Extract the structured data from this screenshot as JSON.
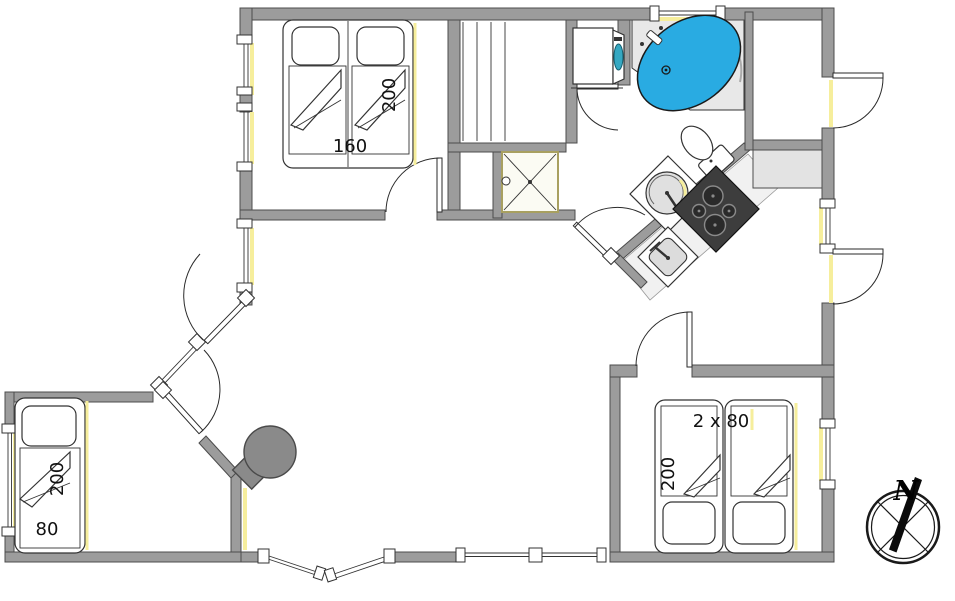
{
  "floorplan": {
    "type": "holiday-house-floor-plan",
    "colors": {
      "wall": "#9c9c9c",
      "wall_outline": "#4c4c4c",
      "window_highlight": "#f6ee9c",
      "bathtub_water": "#29abe2",
      "wood_stove": "#8a8a8a",
      "cooktop": "#3d3d3d",
      "burner": "#2a2a2a",
      "washer_door": "#35a8c2",
      "counter": "#f1f1f1",
      "closet": "#e3e3e3",
      "platform": "#e8e8e8"
    },
    "rooms": {
      "bedroom_nw": {
        "bed_width": "160",
        "bed_length": "200"
      },
      "bedroom_sw": {
        "bed_width": "80",
        "bed_length": "200"
      },
      "bedroom_se": {
        "bed_width": "2 x 80",
        "bed_length": "200"
      }
    },
    "compass": {
      "north": "N"
    },
    "fixtures": [
      "double-bed",
      "single-bed",
      "twin-beds",
      "sauna-benches",
      "shower",
      "washing-machine",
      "corner-bathtub",
      "toilet",
      "washbasin",
      "cooktop",
      "kitchen-sink",
      "wood-burning-stove",
      "closet"
    ]
  }
}
